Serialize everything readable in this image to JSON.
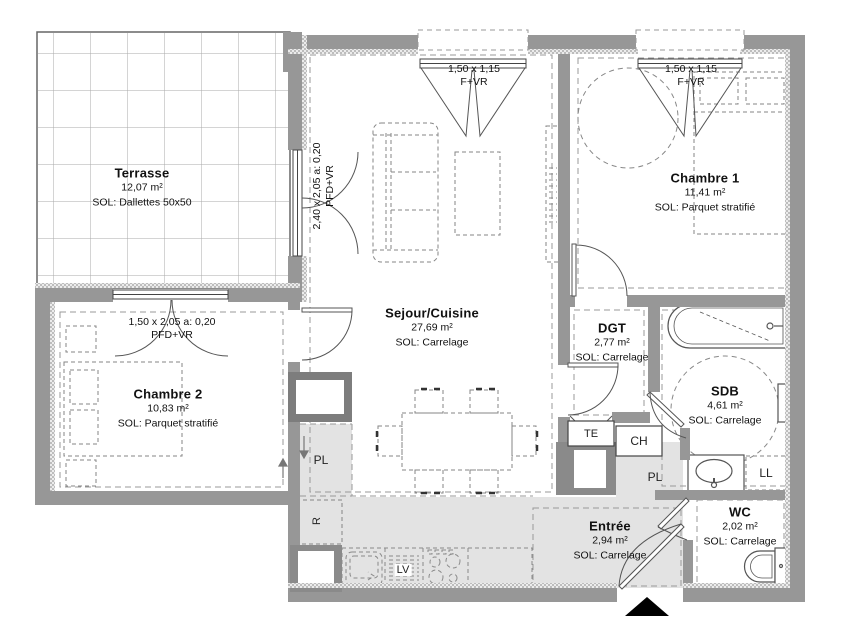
{
  "plan": {
    "rooms": {
      "terrasse": {
        "name": "Terrasse",
        "area": "12,07 m²",
        "floor": "SOL: Dallettes 50x50"
      },
      "sejour": {
        "name": "Sejour/Cuisine",
        "area": "27,69 m²",
        "floor": "SOL: Carrelage"
      },
      "chambre1": {
        "name": "Chambre 1",
        "area": "11,41 m²",
        "floor": "SOL: Parquet stratifié"
      },
      "chambre2": {
        "name": "Chambre 2",
        "area": "10,83 m²",
        "floor": "SOL: Parquet stratifié"
      },
      "dgt": {
        "name": "DGT",
        "area": "2,77 m²",
        "floor": "SOL: Carrelage"
      },
      "sdb": {
        "name": "SDB",
        "area": "4,61 m²",
        "floor": "SOL: Carrelage"
      },
      "wc": {
        "name": "WC",
        "area": "2,02 m²",
        "floor": "SOL: Carrelage"
      },
      "entree": {
        "name": "Entrée",
        "area": "2,94 m²",
        "floor": "SOL: Carrelage"
      }
    },
    "openings": {
      "sejour_top_window": {
        "dims": "1,50 x 1,15",
        "type": "F+VR"
      },
      "chambre1_top_window": {
        "dims": "1,50 x 1,15",
        "type": "F+VR"
      },
      "terrace_door": {
        "dims": "2,40 x 2,05 a: 0,20",
        "type": "PFD+VR"
      },
      "chambre2_window": {
        "dims": "1,50 x 2,05 a: 0,20",
        "type": "PFD+VR"
      }
    },
    "equipment": {
      "electrical_panel": "TE",
      "water_heater": "CH",
      "closet_entree": "PL",
      "closet_sejour": "PL",
      "fridge": "R",
      "dishwasher": "LV",
      "washing_machine": "LL"
    },
    "colors": {
      "wall": "#979797",
      "shaded_floor": "#e3e3e3",
      "line": "#555555",
      "dash": "#888888"
    }
  }
}
